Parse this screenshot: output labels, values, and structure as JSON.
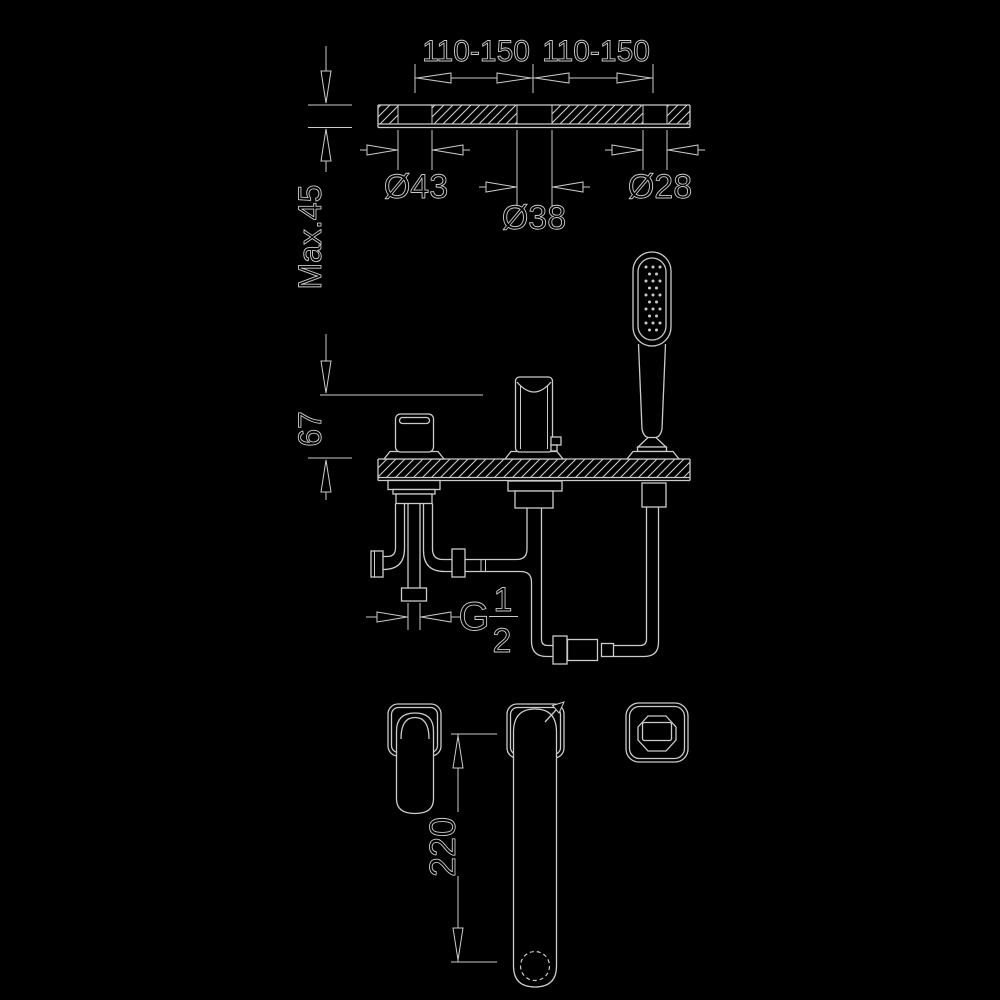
{
  "colors": {
    "background": "#000000",
    "line": "#cbcbcb"
  },
  "drawing": {
    "type": "bath-mixer-installation-dimension-drawing",
    "labels": {
      "span_left": "110-150",
      "span_right": "110-150",
      "dia_left": "Ø43",
      "dia_center": "Ø38",
      "dia_right": "Ø28",
      "deck_max_thickness": "Max.45",
      "spout_height": "67",
      "thread_letter": "G",
      "thread_numerator": "1",
      "thread_denominator": "2",
      "spout_reach": "220"
    }
  }
}
